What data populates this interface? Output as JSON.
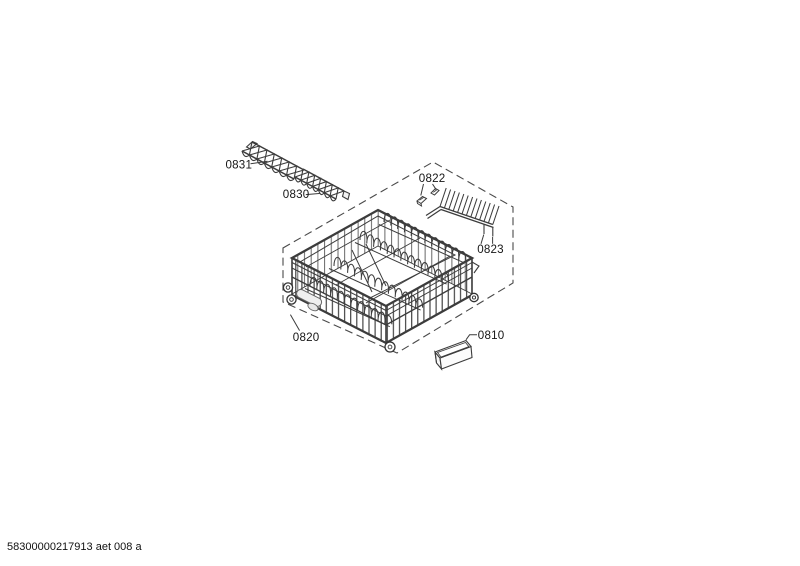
{
  "footer": {
    "code": "58300000217913 aet 008 a"
  },
  "parts": {
    "0831": {
      "label": "0831"
    },
    "0830": {
      "label": "0830"
    },
    "0822": {
      "label": "0822"
    },
    "0823": {
      "label": "0823"
    },
    "0820": {
      "label": "0820"
    },
    "0810": {
      "label": "0810"
    }
  },
  "colors": {
    "line": "#3c3c3c",
    "dashed_boundary": "#4a4a4a",
    "background": "#ffffff",
    "handle_fill": "#efefef"
  }
}
